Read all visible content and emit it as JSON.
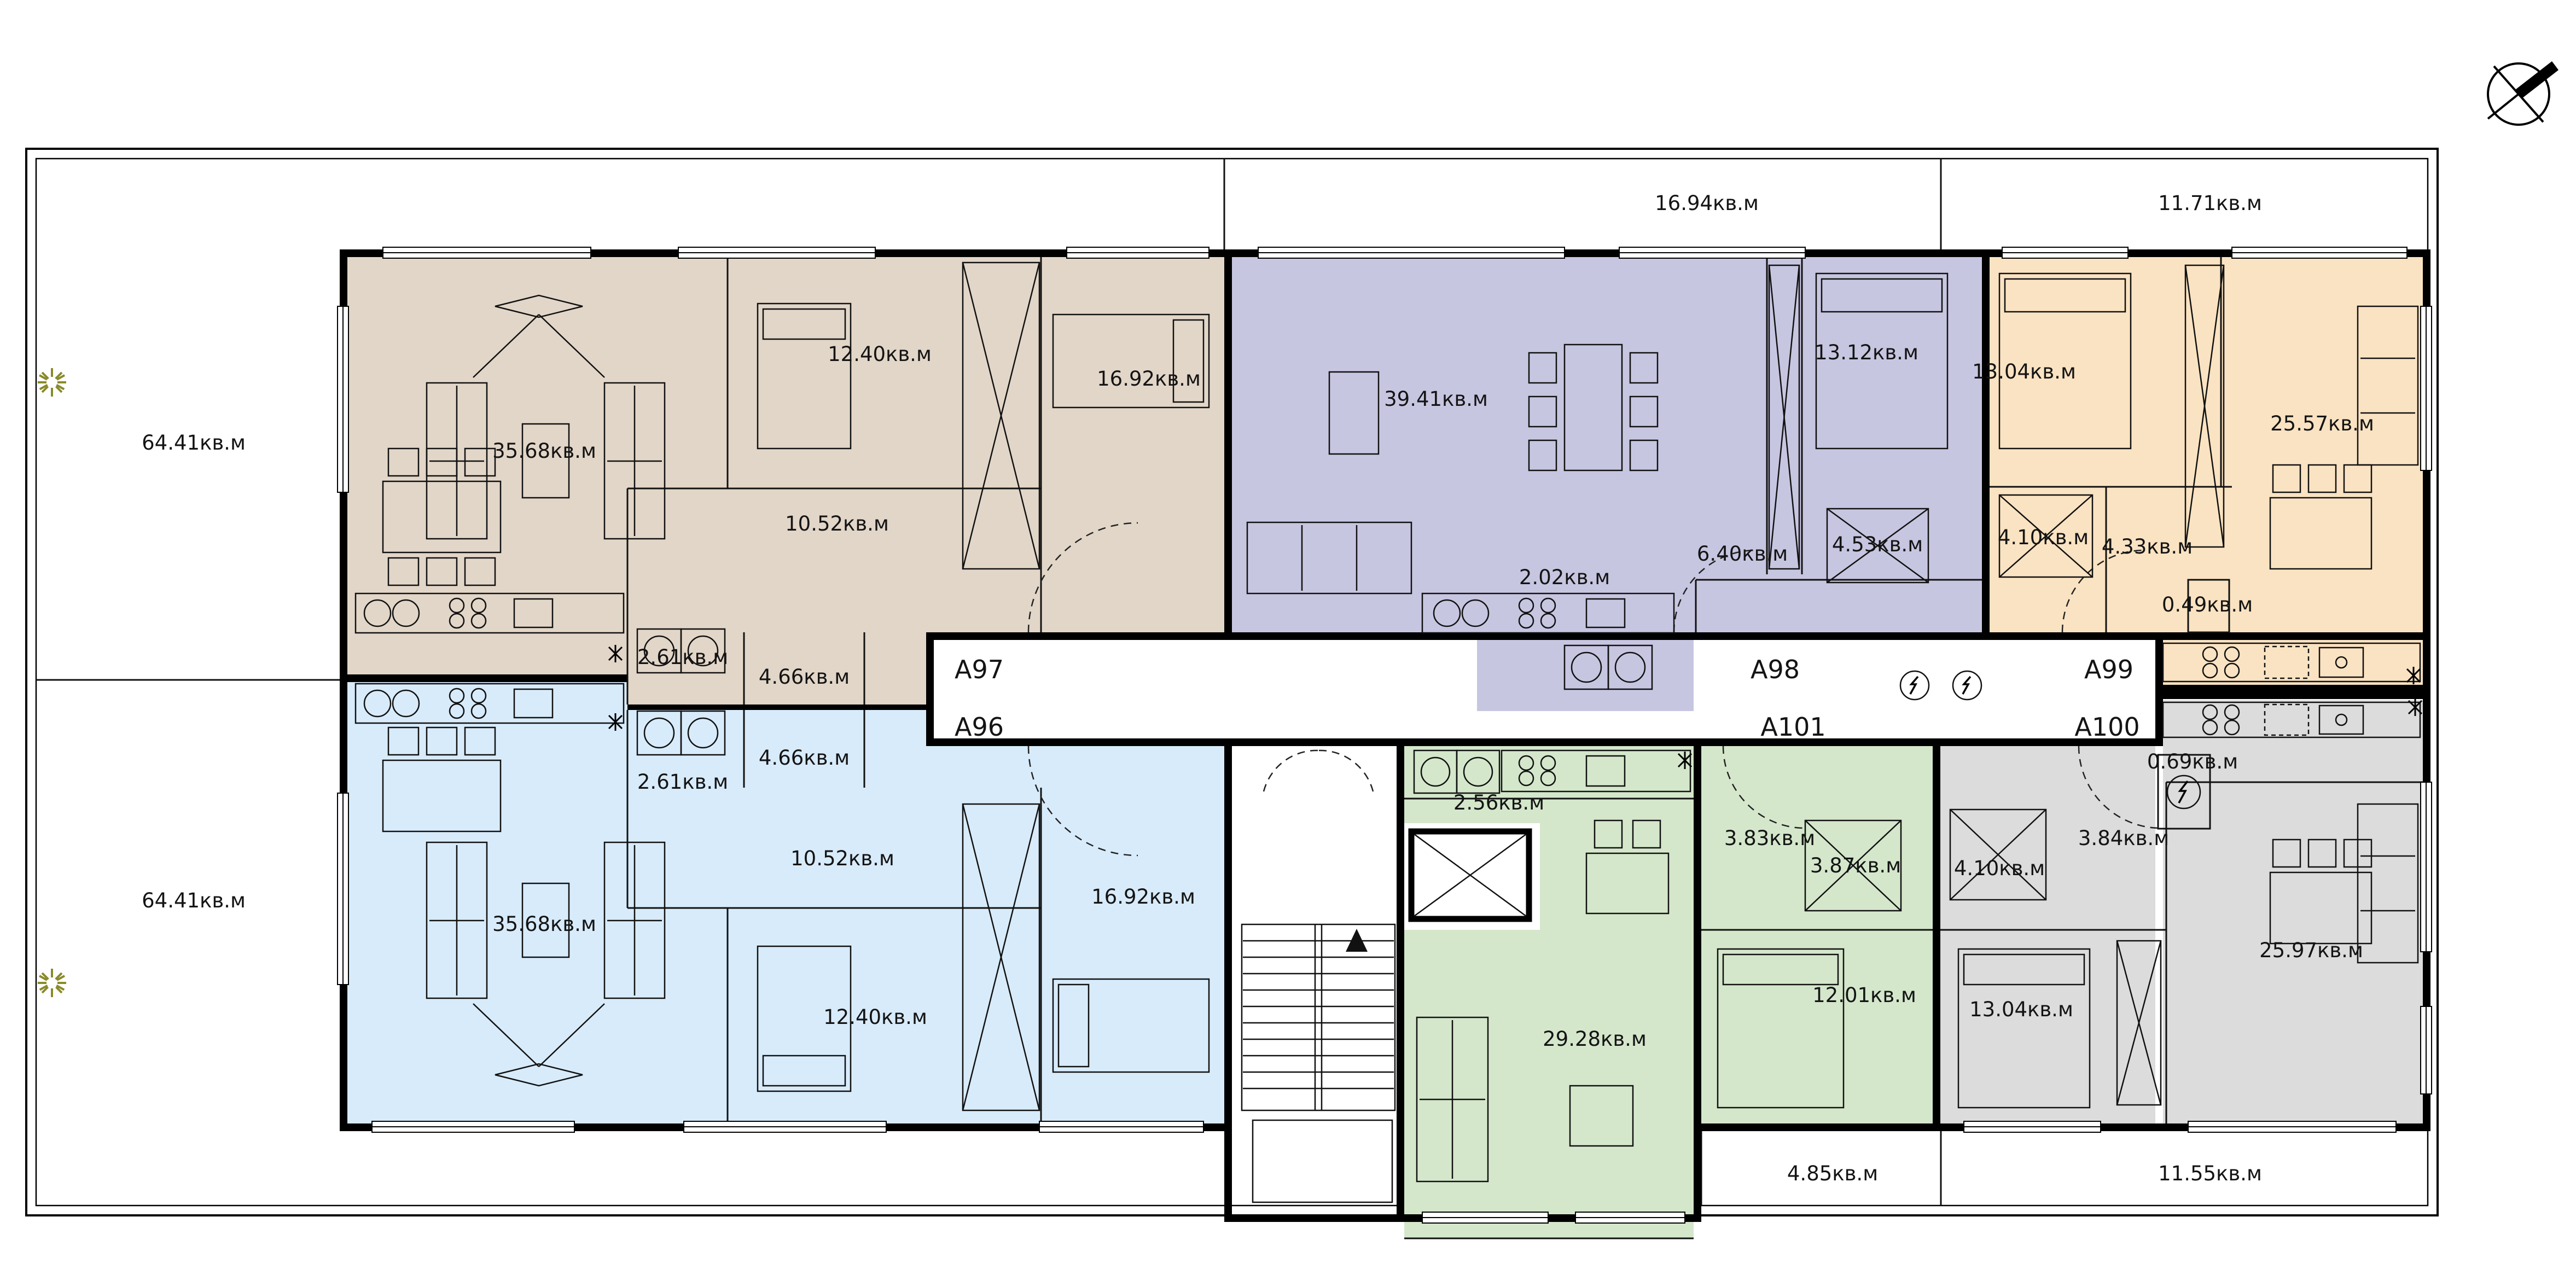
{
  "plan_title": "floor-plan",
  "terrace_labels": {
    "top_mid": "16.94кв.м",
    "top_right": "11.71кв.м",
    "left_upper": "64.41кв.м",
    "left_lower": "64.41кв.м",
    "bottom_mid": "4.85кв.м",
    "bottom_right": "11.55кв.м"
  },
  "apartments": [
    {
      "id": "A97",
      "color": "#e2d6c8",
      "rooms": {
        "living": "35.68кв.м",
        "bedroom_small": "12.40кв.м",
        "bedroom_large": "16.92кв.м",
        "hall": "10.52кв.м",
        "wc": "2.61кв.м",
        "bath": "4.66кв.м"
      }
    },
    {
      "id": "A98",
      "color": "#c7c6e1",
      "rooms": {
        "living": "39.41кв.м",
        "bedroom": "13.12кв.м",
        "bath": "4.53кв.м",
        "hall": "6.40кв.м",
        "kitchen": "2.02кв.м"
      }
    },
    {
      "id": "A99",
      "color": "#fae3c2",
      "rooms": {
        "bedroom": "13.04кв.м",
        "living": "25.57кв.м",
        "shower": "4.10кв.м",
        "hall": "4.33кв.м",
        "closet": "0.49кв.м"
      }
    },
    {
      "id": "A96",
      "color": "#d8ebfa",
      "rooms": {
        "living": "35.68кв.м",
        "bedroom_small": "12.40кв.м",
        "bedroom_large": "16.92кв.м",
        "hall": "10.52кв.м",
        "wc": "2.61кв.м",
        "bath": "4.66кв.м"
      }
    },
    {
      "id": "A101",
      "color": "#d4e7cb",
      "rooms": {
        "kitchen": "2.56кв.м",
        "hall": "3.83кв.м",
        "shower": "3.87кв.м",
        "bedroom": "12.01кв.м",
        "living": "29.28кв.м"
      }
    },
    {
      "id": "A100",
      "color": "#dcdcdc",
      "rooms": {
        "shower": "4.10кв.м",
        "hall": "3.84кв.м",
        "closet": "0.69кв.м",
        "bedroom": "13.04кв.м",
        "living": "25.97кв.м"
      }
    }
  ]
}
